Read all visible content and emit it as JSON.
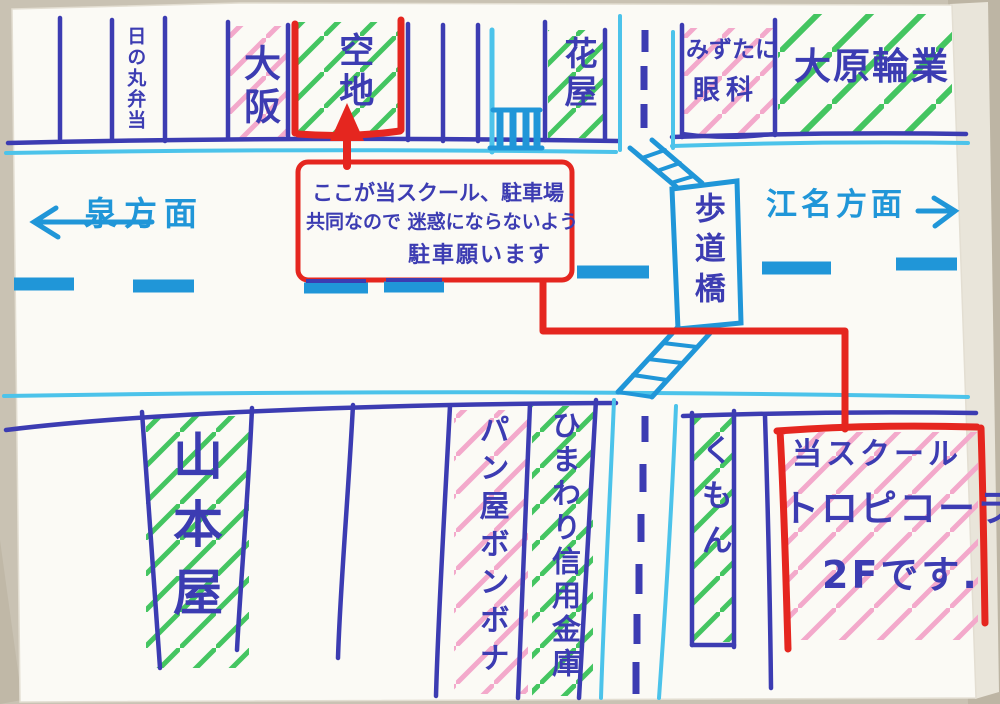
{
  "canvas": {
    "width": 1000,
    "height": 704,
    "kind": "hand-drawn direction map on white paper"
  },
  "colors": {
    "marker_navy": "#3c3cb2",
    "marker_cyan_light": "#4cc3ea",
    "marker_cyan_deep": "#2096d8",
    "marker_red": "#e5261f",
    "hatch_green": "#44c561",
    "hatch_pink": "#f3a9cb",
    "paper": "#fbfaf5",
    "table": "#cfc8ba"
  },
  "directions": {
    "west": "泉方面",
    "east": "江名方面"
  },
  "bridge": {
    "label": "歩道橋"
  },
  "buildings": {
    "hinomaru": "日の丸弁当",
    "osaka": "大阪",
    "akichi": "空地",
    "hanaya": "花屋",
    "mizutani_line1": "みずたに",
    "mizutani_line2": "眼科",
    "ohara": "大原輪業",
    "yamamotoya": "山本屋",
    "panya": "パン屋ボンボナ",
    "shinkin": "ひまわり信用金庫",
    "kumon": "くもん"
  },
  "parking_note": {
    "line1": "ここが当スクール、駐車場",
    "line2": "共同なので 迷惑にならないよう",
    "line3": "駐車願います"
  },
  "school": {
    "line1": "当スクール",
    "line2": "トロピコーラ",
    "line3": "2Fです."
  }
}
